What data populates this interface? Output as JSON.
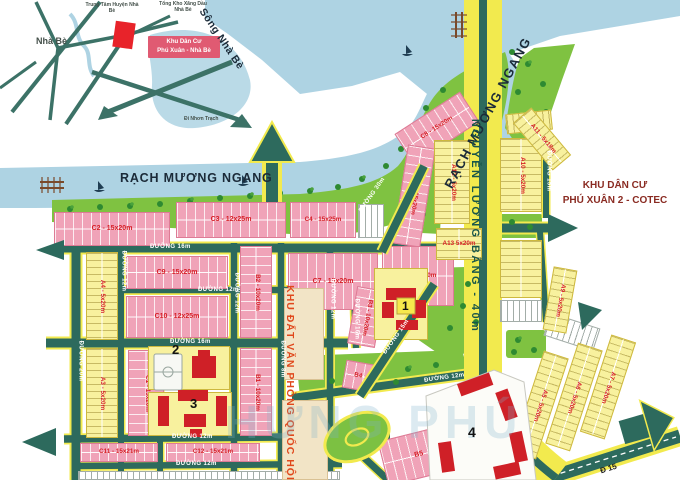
{
  "inset": {
    "area_label": "Nhà Bè",
    "center_label": "Trung Tâm Huyện Nhà Bè",
    "depot_label": "Tổng Kho Xăng Dầu Nhà Bè",
    "project_line1": "Khu Dân Cư",
    "project_line2": "Phú Xuân - Nhà Bè",
    "highway_label": "Xa Lộ Bắc Nam",
    "direction_label": "Đi Nhơn Trạch"
  },
  "main": {
    "river_label": "Sông Nhà Bè",
    "canal_label": "RẠCH MƯƠNG NGANG",
    "canal_label_vertical": "RẠCH MƯƠNG NGANG",
    "avenue_label": "NGUYỄN LƯƠNG BẰNG - 40m",
    "neighbor_line1": "KHU DÂN CƯ",
    "neighbor_line2": "PHÚ XUÂN 2 - COTEC",
    "office_land_label": "KHU ĐẤT VĂN PHÒNG QUỐC HỘI",
    "route15_label": "Đ 15",
    "watermark": "HƯNG PHÚ"
  },
  "roads": {
    "r16a": "ĐƯỜNG 16m",
    "r12a": "ĐƯỜNG 12m",
    "r16b": "ĐƯỜNG 16m",
    "r12b": "ĐƯỜNG 12m",
    "r12c": "ĐƯỜNG 12m",
    "r20v": "ĐƯỜNG 20m",
    "r12v1": "ĐƯỜNG 12m",
    "r12v2": "ĐƯỜNG 12m",
    "r8v": "ĐƯỜNG 8m",
    "r12v3": "ĐƯỜNG 12m",
    "r16v": "ĐƯỜNG 16m",
    "r30d": "ĐƯỜNG 30m",
    "r15d": "ĐƯỜNG 15m",
    "r15v": "ĐƯỜNG 15m",
    "r12d": "ĐƯỜNG 12m"
  },
  "blocks": {
    "c1": "C1 - 15x20m",
    "c2": "C2 - 15x20m",
    "c3": "C3 - 12x25m",
    "c4": "C4 - 15x25m",
    "c5": "C5 - 15x20m",
    "c6": "C6 - 15x20m",
    "c7": "C7 - 15x20m",
    "c8": "C8 - 15x20m",
    "c9": "C9 - 15x20m",
    "c10": "C10 - 12x25m",
    "c11": "C11 - 15x21m",
    "c12": "C12 - 15x21m",
    "b1": "B1 - 10x20m",
    "b2": "B2 - 10x20m",
    "b3": "B3 - 10x20m",
    "b4": "B4",
    "b5": "B5",
    "a3": "A3 - 5x20m",
    "a4": "A4 - 5x20m",
    "a5": "A5 - 5x20m",
    "a6": "A6 - 5x20m",
    "a7": "A7 - 5x20m",
    "a9": "A9 - 5x20m",
    "a10": "A10 - 5x20m",
    "a11": "A11 - 5x18m",
    "a12": "A12 - 5x20m",
    "a13": "A13 5x20m",
    "lot520": "5x20m"
  },
  "buildings": {
    "n1": "1",
    "n2": "2",
    "n3": "3",
    "n4": "4"
  },
  "colors": {
    "water": "#aed3e3",
    "park": "#7fc241",
    "road": "#2d6a5d",
    "road_edge": "#f2ea4e",
    "pink_block": "#f0a3b8",
    "yellow_block": "#f8f19e",
    "tan_block": "#f2e4c6",
    "label_red": "#d61f26",
    "building_red": "#cf2027",
    "project_box": "#e05a72",
    "cotec_text": "#8a2b22",
    "office_text": "#e0481c"
  }
}
